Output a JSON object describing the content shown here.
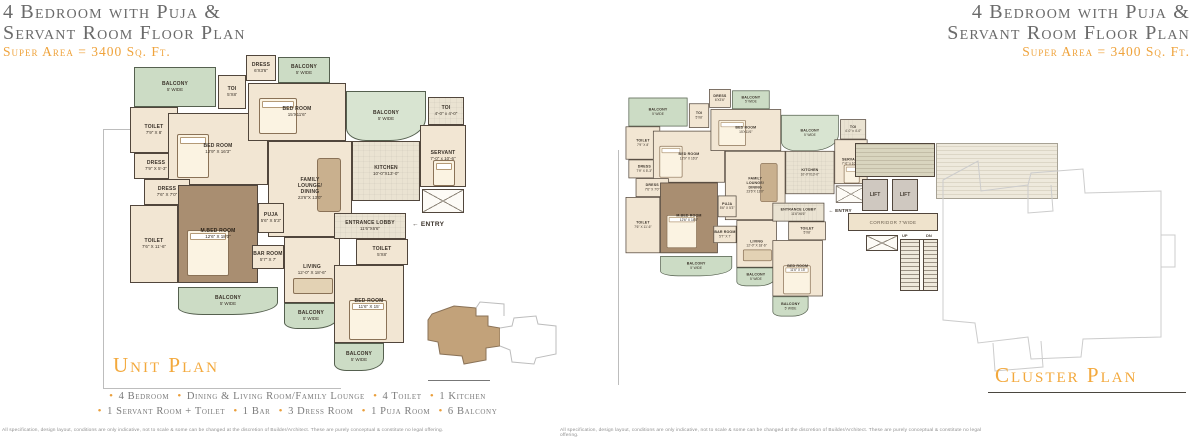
{
  "header": {
    "title_line1": "4 Bedroom with Puja &",
    "title_line2": "Servant Room Floor Plan",
    "super_area": "Super Area = 3400 Sq. Ft."
  },
  "unit_plan": {
    "title": "Unit Plan",
    "entry_arrow": "←",
    "entry_label": "ENTRY",
    "rooms": {
      "balcony_tl": {
        "label": "BALCONY",
        "dim": "5' WIDE"
      },
      "toilet_tl": {
        "label": "TOILET",
        "dim": "7'9\" X 8'"
      },
      "dress_left": {
        "label": "DRESS",
        "dim": "7'9\" X 5'-3\""
      },
      "bedroom_left": {
        "label": "BED ROOM",
        "dim": "12'9\" X 16'3\""
      },
      "dress_mid": {
        "label": "DRESS",
        "dim": "7'6\" X 7'0\""
      },
      "toilet_left": {
        "label": "TOILET",
        "dim": "7'6\" X 11'-6\""
      },
      "master_bedroom": {
        "label": "M.BED ROOM",
        "dim": "12'6\" X 18'0\""
      },
      "puja": {
        "label": "PUJA",
        "dim": "5'6\" X 5'3\""
      },
      "family_lounge": {
        "label": "FAMILY LOUNGE/ DINING",
        "dim": "23'6\"X 13'0\""
      },
      "bar": {
        "label": "BAR ROOM",
        "dim": "5'7\" X 7'"
      },
      "living": {
        "label": "LIVING",
        "dim": "12'-0\" X 18'-6\""
      },
      "balcony_bl": {
        "label": "BALCONY",
        "dim": "5' WIDE"
      },
      "balcony_br": {
        "label": "BALCONY",
        "dim": "5' WIDE"
      },
      "toi_top": {
        "label": "TOI",
        "dim": "5'X8'"
      },
      "dress_top": {
        "label": "DRESS",
        "dim": "6'X3'6\""
      },
      "balcony_top": {
        "label": "BALCONY",
        "dim": "5' WIDE"
      },
      "bedroom_top": {
        "label": "BED ROOM",
        "dim": "15'X11'6\""
      },
      "balcony_mid": {
        "label": "BALCONY",
        "dim": "5' WIDE"
      },
      "kitchen": {
        "label": "KITCHEN",
        "dim": "10'-0\"X13'-0\""
      },
      "servant": {
        "label": "SERVANT",
        "dim": "7'-0\" x 10'-6\""
      },
      "toi_servant": {
        "label": "TOI",
        "dim": "4'-0\" x 4'-0\""
      },
      "entrance_lobby": {
        "label": "ENTRANCE LOBBY",
        "dim": "11'6\"X6'6\""
      },
      "toilet_entry": {
        "label": "TOILET",
        "dim": "5'X8'"
      },
      "bedroom_bottom": {
        "label": "BED ROOM",
        "dim": "11'6\" X 15'"
      },
      "balcony_bottom": {
        "label": "BALCONY",
        "dim": "5' WIDE"
      }
    }
  },
  "cluster_plan": {
    "title": "Cluster Plan",
    "core": {
      "lift1": "LIFT",
      "lift2": "LIFT",
      "corridor": "CORRIDOR 7'WIDE",
      "up": "UP",
      "dn": "DN"
    }
  },
  "legend": {
    "line1": [
      "4 Bedroom",
      "Dining & Living Room/Family Lounge",
      "4 Toilet",
      "1 Kitchen"
    ],
    "line2": [
      "1 Servant Room + Toilet",
      "1 Bar",
      "3 Dress Room",
      "1 Puja Room",
      "6 Balcony"
    ]
  },
  "disclaimer": "All specification, design layout, conditions are only indicative, not to scale & some can be changed at the discretion of Builder/Architect. These are purely conceptual & constitute no legal offering.",
  "colors": {
    "accent_orange": "#F0A43C",
    "title_gray": "#6A6A6A",
    "wall": "#51463C",
    "floor": "#F2E6D3",
    "master_floor": "#A98E71",
    "balcony_green": "#CCDCC5"
  }
}
